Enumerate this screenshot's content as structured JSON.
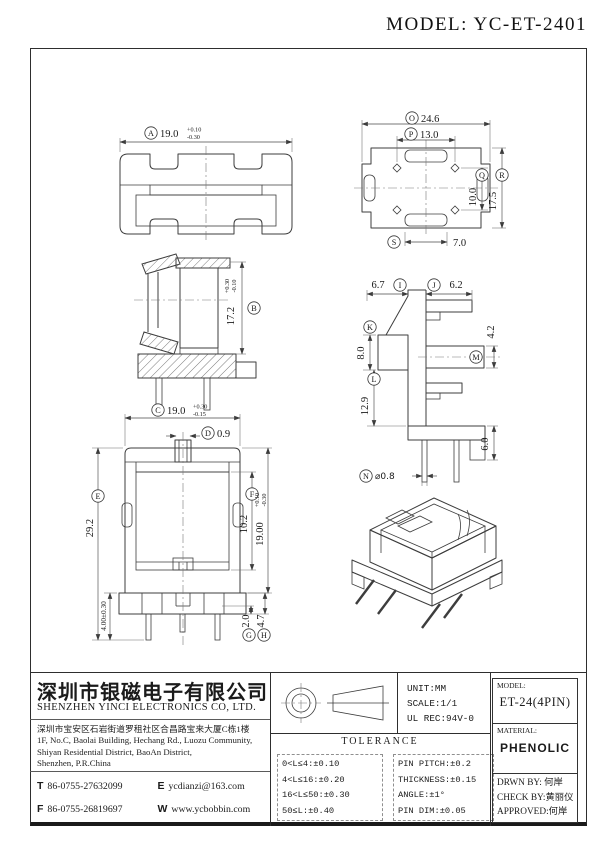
{
  "page_title": "MODEL: YC-ET-2401",
  "dims": {
    "A": {
      "letter": "A",
      "value": "19.0",
      "tol_up": "+0.10",
      "tol_dn": "-0.30"
    },
    "B": {
      "letter": "B",
      "value": "17.2",
      "tol_up": "+0.30",
      "tol_dn": "-0.10"
    },
    "C": {
      "letter": "C",
      "value": "19.0",
      "tol_up": "+0.30",
      "tol_dn": "-0.15"
    },
    "D": {
      "letter": "D",
      "value": "0.9"
    },
    "E": {
      "letter": "E",
      "value": "29.2"
    },
    "F": {
      "letter": "F",
      "value": "10.2"
    },
    "G": {
      "letter": "G",
      "value": "2.0"
    },
    "H": {
      "letter": "H",
      "value": "4.7"
    },
    "I": {
      "letter": "I",
      "value": "6.7"
    },
    "J": {
      "letter": "J",
      "value": "6.2"
    },
    "K": {
      "letter": "K",
      "value": "8.0"
    },
    "L": {
      "letter": "L",
      "value": "12.9"
    },
    "M": {
      "letter": "M",
      "value": "4.2"
    },
    "N": {
      "letter": "N",
      "value": "⌀0.8"
    },
    "O": {
      "letter": "O",
      "value": "24.6"
    },
    "P": {
      "letter": "P",
      "value": "13.0"
    },
    "Q": {
      "letter": "Q",
      "value": "10.0"
    },
    "R": {
      "letter": "R",
      "value": "17.5"
    },
    "S": {
      "letter": "S",
      "value": "7.0"
    },
    "body_height": {
      "value": "19.00",
      "tol_up": "+0.10",
      "tol_dn": "-0.30"
    },
    "base_height": {
      "value": "4.00±0.30"
    },
    "foot": {
      "value": "6.0"
    }
  },
  "footer": {
    "company": {
      "name_cn": "深圳市银磁电子有限公司",
      "name_en": "SHENZHEN YINCI ELECTRONICS CO, LTD.",
      "address_cn": "深圳市宝安区石岩街道罗租社区合昌路宝来大厦C栋1楼",
      "address_en1": "1F, No.C, Baolai Building, Hechang Rd., Luozu Community,",
      "address_en2": "Shiyan Residential District, BaoAn District,",
      "address_en3": "Shenzhen, P.R.China",
      "tel_label": "T",
      "tel": "86-0755-27632099",
      "email_label": "E",
      "email": "ycdianzi@163.com",
      "fax_label": "F",
      "fax": "86-0755-26819697",
      "web_label": "W",
      "web": "www.ycbobbin.com"
    },
    "specs": {
      "unit": "UNIT:MM",
      "scale": "SCALE:1/1",
      "ul": "UL REC:94V-0"
    },
    "tolerance": {
      "title": "TOLERANCE",
      "left": [
        "0<L≤4:±0.10",
        "4<L≤16:±0.20",
        "16<L≤50:±0.30",
        "50≤L:±0.40"
      ],
      "right": [
        "PIN PITCH:±0.2",
        "THICKNESS:±0.15",
        "ANGLE:±1°",
        "PIN DIM:±0.05"
      ]
    },
    "title_block": {
      "model_label": "MODEL:",
      "model": "ET-24(4PIN)",
      "material_label": "MATERIAL:",
      "material": "PHENOLIC",
      "drawn": "DRWN BY: 何岸",
      "checked": "CHECK BY:黄丽仪",
      "approved": "APPROVED:何岸"
    }
  }
}
